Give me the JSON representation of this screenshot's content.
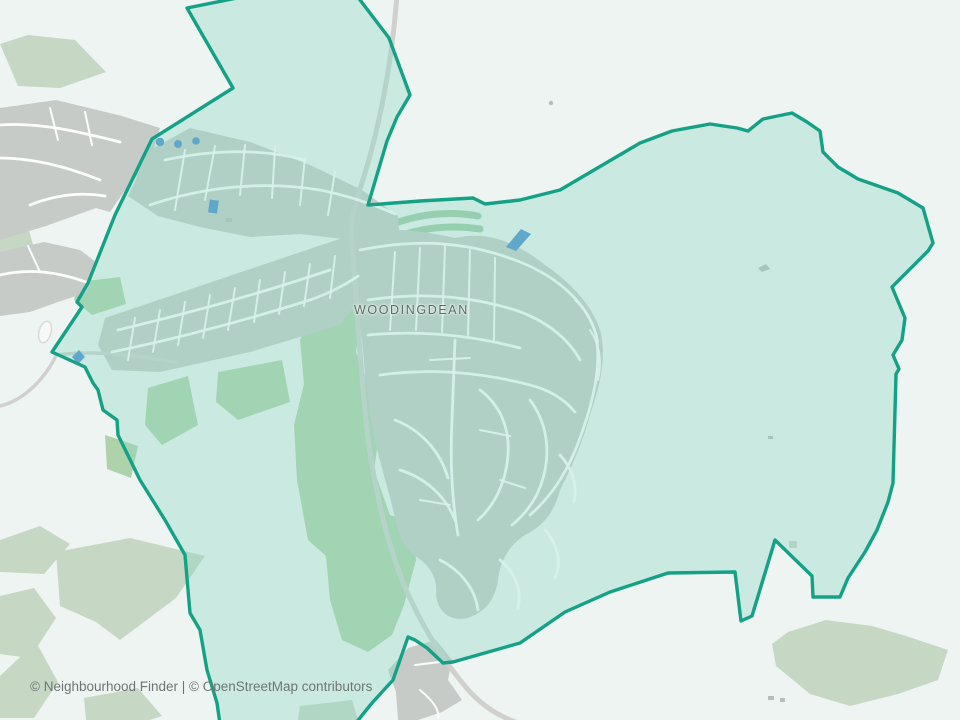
{
  "map": {
    "place_label": "WOODINGDEAN",
    "attribution": "© Neighbourhood Finder | © OpenStreetMap contributors"
  },
  "colors": {
    "background": "#eef4f1",
    "boundary_stroke": "#14a186",
    "boundary_fill": "rgba(134,214,195,0.35)",
    "greenspace": "#c6d8c4",
    "greenspace_bright": "#aed3ab",
    "rec_ground": "#c2e3bd",
    "allotment": "#9fcba6",
    "urban": "#c7cbc7",
    "road_outside": "#d0d1ce",
    "street": "#ffffff",
    "water": "#4a90d2",
    "scribble": "#b6beba",
    "label_text": "#5c6a64",
    "attribution_text": "#6d7672"
  }
}
